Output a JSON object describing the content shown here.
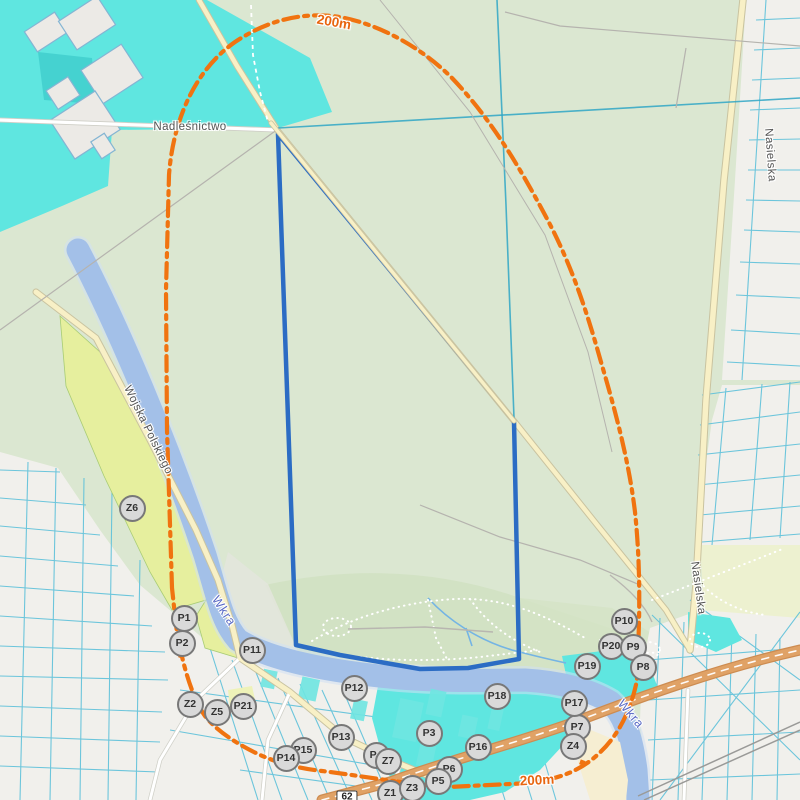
{
  "map": {
    "region_labels": [
      {
        "text": "Nadleśnictwo",
        "x": 190,
        "y": 127,
        "rot": 0,
        "kind": "street"
      },
      {
        "text": "Wojska Polskiego",
        "x": 148,
        "y": 430,
        "rot": 64,
        "kind": "street"
      },
      {
        "text": "Nasielska",
        "x": 770,
        "y": 155,
        "rot": 86,
        "kind": "street"
      },
      {
        "text": "Nasielska",
        "x": 698,
        "y": 588,
        "rot": 82,
        "kind": "street"
      },
      {
        "text": "Wkra",
        "x": 224,
        "y": 611,
        "rot": 57,
        "kind": "river"
      },
      {
        "text": "Wkra",
        "x": 631,
        "y": 714,
        "rot": 50,
        "kind": "river"
      },
      {
        "text": "200m",
        "x": 334,
        "y": 22,
        "rot": 10,
        "kind": "distance"
      },
      {
        "text": "200m",
        "x": 537,
        "y": 780,
        "rot": -3,
        "kind": "distance"
      }
    ],
    "road_shield": {
      "text": "62",
      "x": 347,
      "y": 797
    },
    "markers": [
      {
        "id": "Z6",
        "label": "Z6",
        "x": 132,
        "y": 508
      },
      {
        "id": "P1",
        "label": "P1",
        "x": 184,
        "y": 618
      },
      {
        "id": "P2",
        "label": "P2",
        "x": 182,
        "y": 643
      },
      {
        "id": "P11",
        "label": "P11",
        "x": 252,
        "y": 650
      },
      {
        "id": "Z2",
        "label": "Z2",
        "x": 190,
        "y": 704
      },
      {
        "id": "Z5",
        "label": "Z5",
        "x": 217,
        "y": 712
      },
      {
        "id": "P21",
        "label": "P21",
        "x": 243,
        "y": 706
      },
      {
        "id": "P12",
        "label": "P12",
        "x": 354,
        "y": 688
      },
      {
        "id": "P18",
        "label": "P18",
        "x": 497,
        "y": 696
      },
      {
        "id": "P13",
        "label": "P13",
        "x": 341,
        "y": 737
      },
      {
        "id": "P15",
        "label": "P15",
        "x": 303,
        "y": 750
      },
      {
        "id": "P14",
        "label": "P14",
        "x": 286,
        "y": 758
      },
      {
        "id": "P4",
        "label": "P4",
        "x": 376,
        "y": 755
      },
      {
        "id": "Z7",
        "label": "Z7",
        "x": 388,
        "y": 761
      },
      {
        "id": "P3",
        "label": "P3",
        "x": 429,
        "y": 733
      },
      {
        "id": "P16",
        "label": "P16",
        "x": 478,
        "y": 747
      },
      {
        "id": "P6",
        "label": "P6",
        "x": 449,
        "y": 769
      },
      {
        "id": "P5",
        "label": "P5",
        "x": 438,
        "y": 781
      },
      {
        "id": "Z1",
        "label": "Z1",
        "x": 390,
        "y": 793
      },
      {
        "id": "Z3",
        "label": "Z3",
        "x": 412,
        "y": 788
      },
      {
        "id": "P7",
        "label": "P7",
        "x": 577,
        "y": 727
      },
      {
        "id": "P17",
        "label": "P17",
        "x": 574,
        "y": 703
      },
      {
        "id": "Z4",
        "label": "Z4",
        "x": 573,
        "y": 746
      },
      {
        "id": "P19",
        "label": "P19",
        "x": 587,
        "y": 666
      },
      {
        "id": "P10",
        "label": "P10",
        "x": 624,
        "y": 621
      },
      {
        "id": "P20",
        "label": "P20",
        "x": 611,
        "y": 646
      },
      {
        "id": "P9",
        "label": "P9",
        "x": 633,
        "y": 647
      },
      {
        "id": "P8",
        "label": "P8",
        "x": 643,
        "y": 667
      }
    ],
    "colors": {
      "site_outline": "#2b6cc4",
      "buffer_line": "#f07310",
      "water_river": "#a3c0e8",
      "water_highlight": "#5fe6e0",
      "forest": "#dbe7d1",
      "scrub": "#e6ef9e",
      "marker_fill": "#d9d9d9",
      "marker_border": "#787878"
    }
  }
}
